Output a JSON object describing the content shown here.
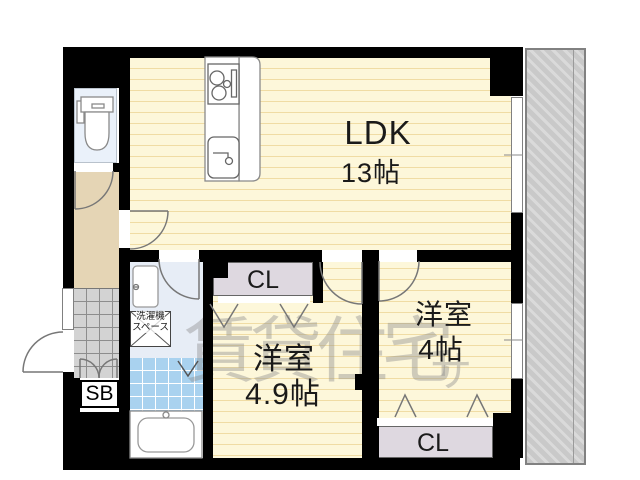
{
  "plan": {
    "rooms": {
      "ldk": {
        "name": "LDK",
        "size": "13帖"
      },
      "bedroom1": {
        "name": "洋室",
        "size": "4.9帖"
      },
      "bedroom2": {
        "name": "洋室",
        "size": "4帖"
      }
    },
    "closet1": {
      "label": "CL"
    },
    "closet2": {
      "label": "CL"
    },
    "shoebox": {
      "label": "SB"
    },
    "laundry": {
      "line1": "洗濯機",
      "line2": "スペース"
    }
  },
  "watermark": {
    "text": "賃貸住宅",
    "mark": "サ"
  },
  "colors": {
    "wall": "#000000",
    "floor_base": "#fdf7da",
    "floor_stripe": "#f0dca4",
    "hallway": "#e5d5b5",
    "toilet": "#eaf1fa",
    "washroom": "#e7edf6",
    "bath_tile": "#a9d2ef",
    "genkan_tile": "#d3d3d3",
    "closet": "#ded8e0",
    "balcony": "#c9c9c9"
  }
}
